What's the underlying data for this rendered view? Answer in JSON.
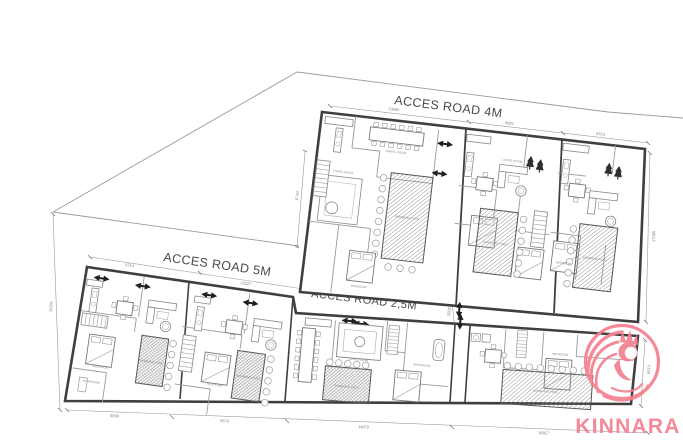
{
  "roads": {
    "road_4m": "ACCES ROAD 4M",
    "road_5m": "ACCES ROAD 5M",
    "road_25m": "ACCES ROAD 2,5M"
  },
  "dimensions": {
    "top_a": "13680",
    "top_b": "8801",
    "top_c": "9753",
    "right_upper": "17085",
    "left_upper": "6710",
    "site_left": "16331",
    "lower_top_a": "9714",
    "lower_top_b": "12027",
    "bottom_a": "9866",
    "bottom_b": "9673",
    "bottom_c": "14070",
    "bottom_d": "16817",
    "path_width": "2500",
    "right_lower": "6510"
  },
  "rooms": {
    "pool": "SWIMMING POOL",
    "bedroom": "BEDROOM",
    "living": "LIVING ROOM",
    "dining": "DINING ROOM",
    "kitchen": "KITCHEN",
    "bathroom": "BATHROOM"
  },
  "logo": {
    "brand": "KINNARA",
    "color": "#f4808f"
  },
  "colors": {
    "wall": "#3f3f3f",
    "furniture_line": "#8a8a8a",
    "dimension_line": "#9a9a9a",
    "background": "#ffffff"
  }
}
